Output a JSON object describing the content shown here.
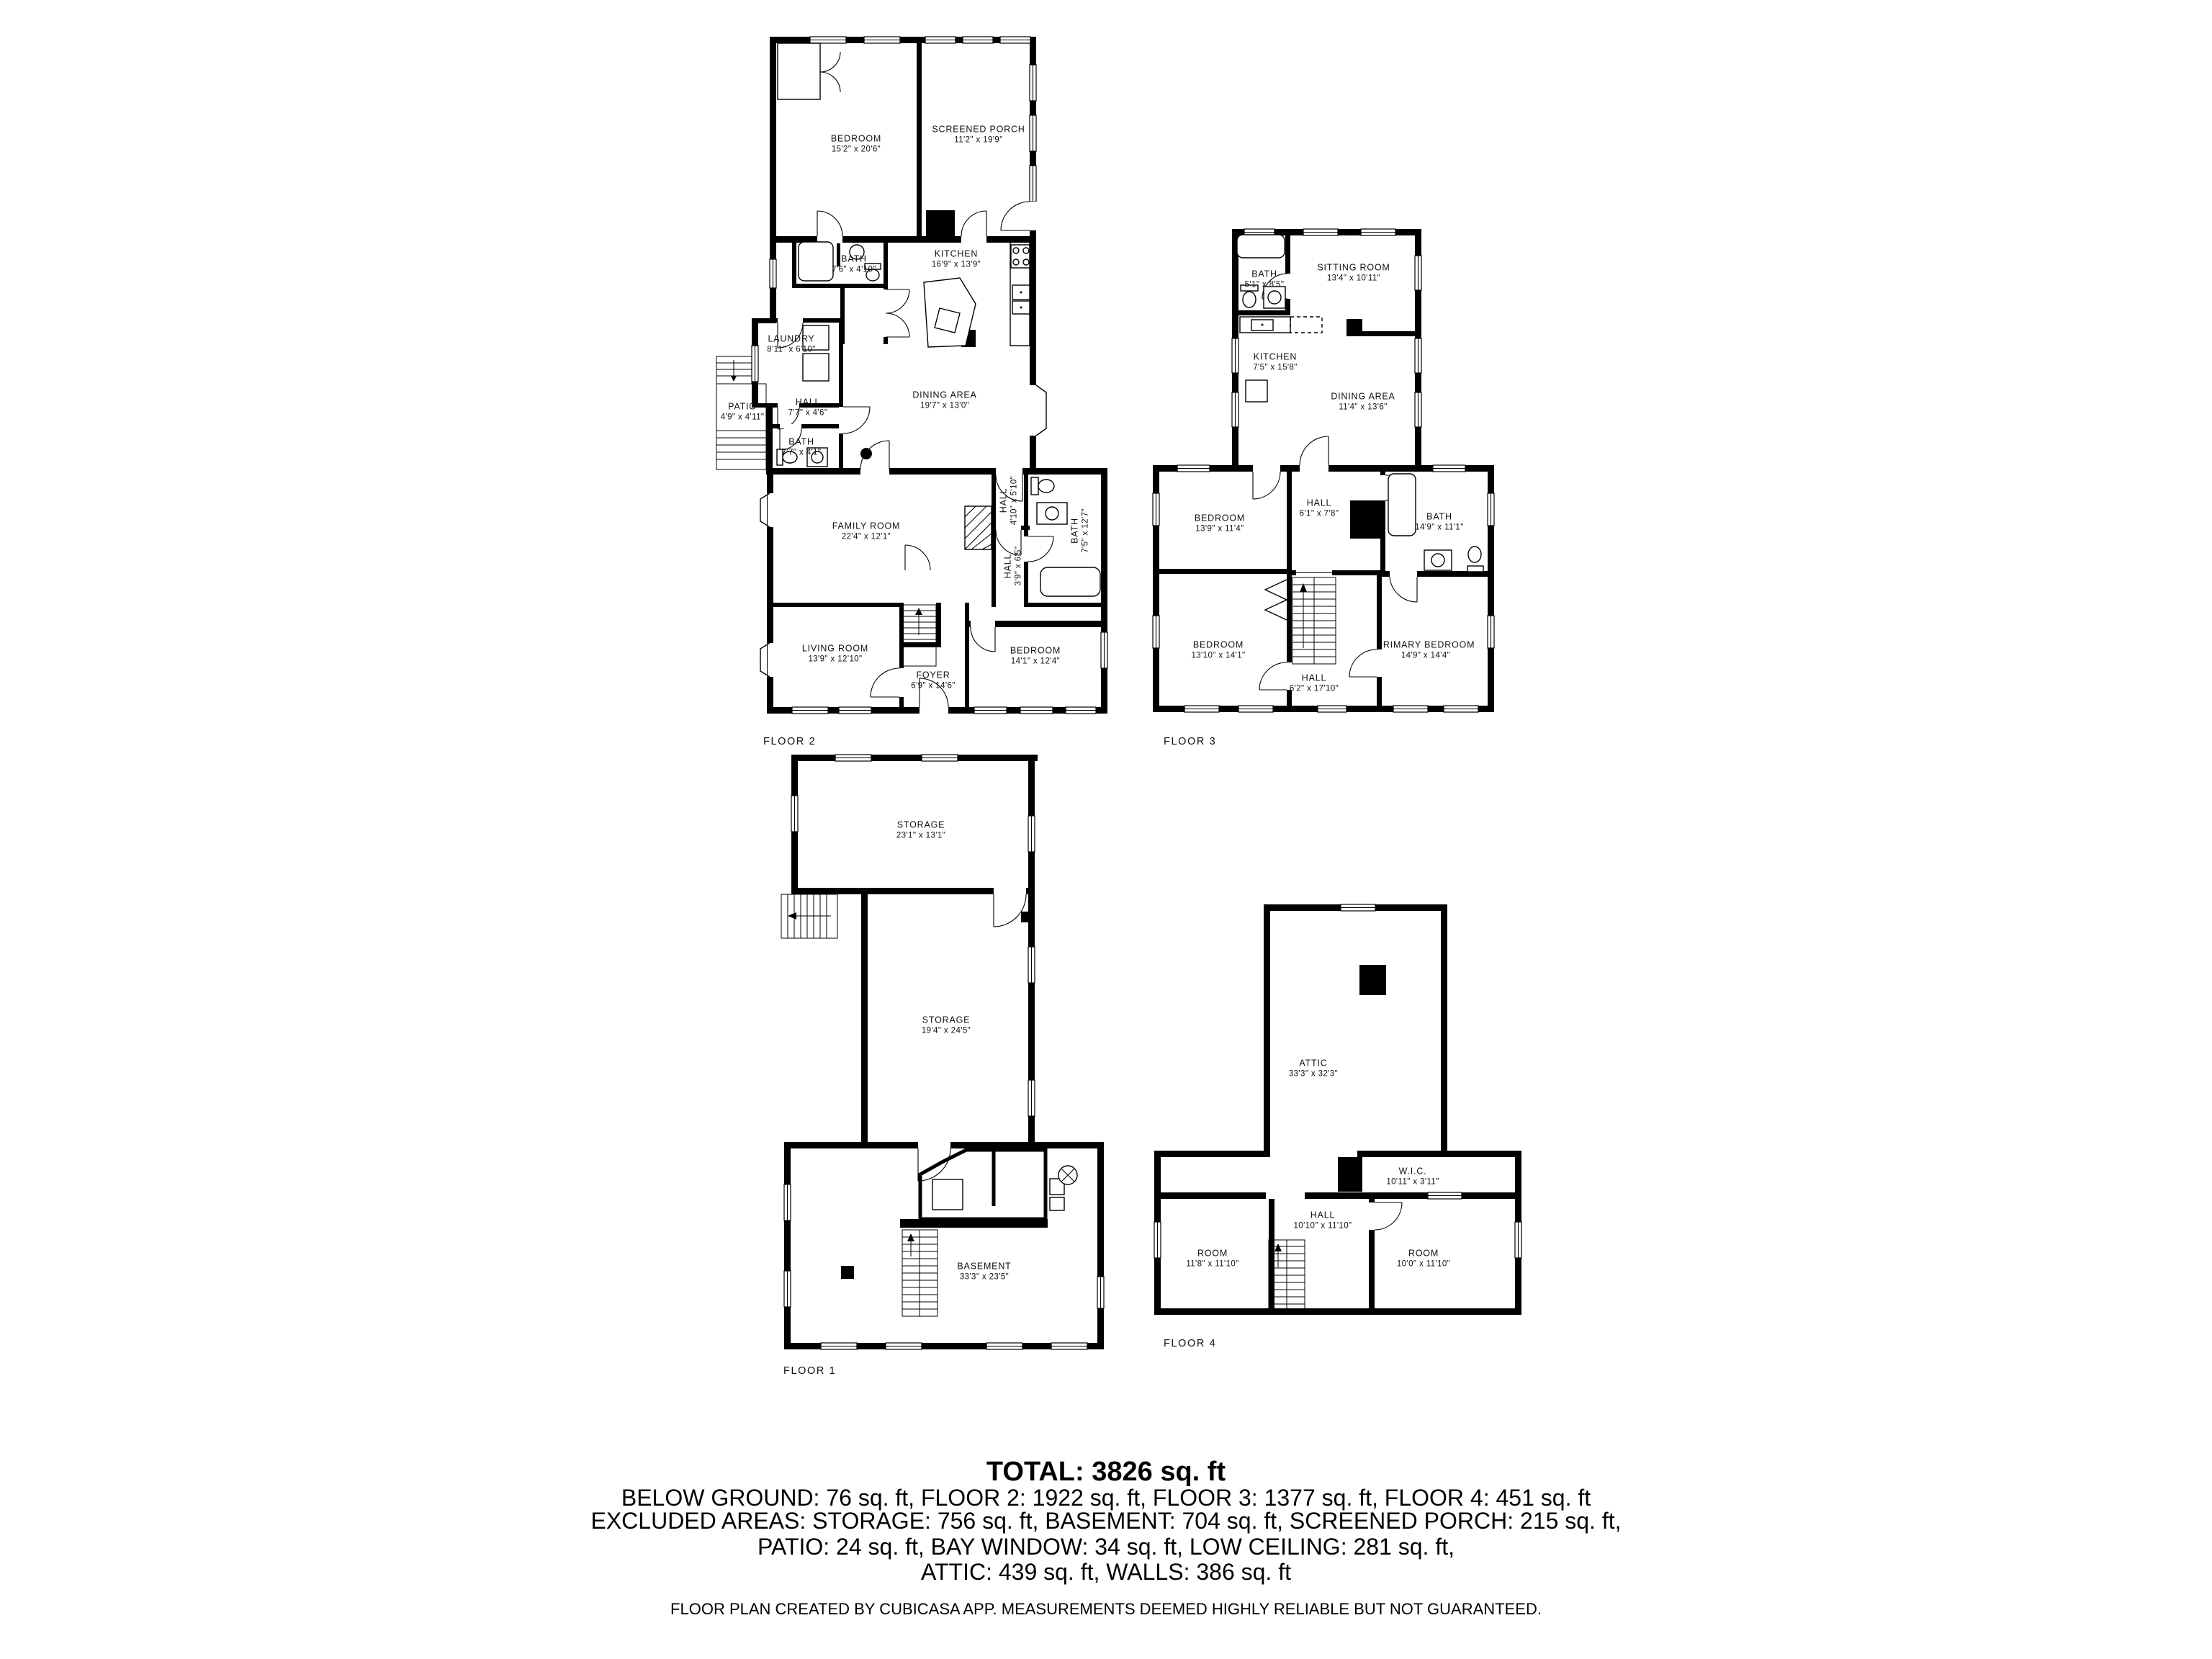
{
  "colors": {
    "wall": "#000000",
    "text": "#111111",
    "background": "#ffffff"
  },
  "floors": [
    {
      "label": "FLOOR 2",
      "rooms": [
        {
          "name": "BEDROOM",
          "dims": "15'2\" x 20'6\""
        },
        {
          "name": "SCREENED PORCH",
          "dims": "11'2\" x 19'9\""
        },
        {
          "name": "BATH",
          "dims": "7'6\" x 4'10\""
        },
        {
          "name": "KITCHEN",
          "dims": "16'9\" x 13'9\""
        },
        {
          "name": "LAUNDRY",
          "dims": "8'11\" x 6'10\""
        },
        {
          "name": "PATIO",
          "dims": "4'9\" x 4'11\""
        },
        {
          "name": "HALL",
          "dims": "7'7\" x 4'6\""
        },
        {
          "name": "BATH",
          "dims": "7'7\" x 4'1\""
        },
        {
          "name": "DINING AREA",
          "dims": "19'7\" x 13'0\""
        },
        {
          "name": "FAMILY ROOM",
          "dims": "22'4\" x 12'1\""
        },
        {
          "name": "HALL",
          "dims": "4'10\" x 5'10\""
        },
        {
          "name": "BATH",
          "dims": "7'5\" x 12'7\""
        },
        {
          "name": "HALL",
          "dims": "3'9\" x 6'5\""
        },
        {
          "name": "LIVING ROOM",
          "dims": "13'9\" x 12'10\""
        },
        {
          "name": "FOYER",
          "dims": "6'9\" x 14'6\""
        },
        {
          "name": "BEDROOM",
          "dims": "14'1\" x 12'4\""
        }
      ]
    },
    {
      "label": "FLOOR 3",
      "rooms": [
        {
          "name": "BATH",
          "dims": "5'1\" x 8'5\""
        },
        {
          "name": "SITTING ROOM",
          "dims": "13'4\" x 10'11\""
        },
        {
          "name": "KITCHEN",
          "dims": "7'5\" x 15'8\""
        },
        {
          "name": "DINING AREA",
          "dims": "11'4\" x 13'6\""
        },
        {
          "name": "BEDROOM",
          "dims": "13'9\" x 11'4\""
        },
        {
          "name": "HALL",
          "dims": "6'1\" x 7'8\""
        },
        {
          "name": "BATH",
          "dims": "14'9\" x 11'1\""
        },
        {
          "name": "BEDROOM",
          "dims": "13'10\" x 14'1\""
        },
        {
          "name": "HALL",
          "dims": "6'2\" x 17'10\""
        },
        {
          "name": "PRIMARY BEDROOM",
          "dims": "14'9\" x 14'4\""
        }
      ]
    },
    {
      "label": "FLOOR 1",
      "rooms": [
        {
          "name": "STORAGE",
          "dims": "23'1\" x 13'1\""
        },
        {
          "name": "STORAGE",
          "dims": "19'4\" x 24'5\""
        },
        {
          "name": "BASEMENT",
          "dims": "33'3\" x 23'5\""
        }
      ]
    },
    {
      "label": "FLOOR 4",
      "rooms": [
        {
          "name": "ATTIC",
          "dims": "33'3\" x 32'3\""
        },
        {
          "name": "W.I.C.",
          "dims": "10'11\" x 3'11\""
        },
        {
          "name": "HALL",
          "dims": "10'10\" x 11'10\""
        },
        {
          "name": "ROOM",
          "dims": "11'8\" x 11'10\""
        },
        {
          "name": "ROOM",
          "dims": "10'0\" x 11'10\""
        }
      ]
    }
  ],
  "summary": {
    "total": "TOTAL: 3826 sq. ft",
    "lines": [
      "BELOW GROUND: 76 sq. ft, FLOOR 2: 1922 sq. ft, FLOOR 3: 1377 sq. ft, FLOOR 4: 451 sq. ft",
      "EXCLUDED AREAS: STORAGE: 756 sq. ft, BASEMENT: 704 sq. ft, SCREENED PORCH: 215 sq. ft,",
      "PATIO: 24 sq. ft, BAY WINDOW: 34 sq. ft, LOW CEILING: 281 sq. ft,",
      "ATTIC: 439 sq. ft, WALLS: 386 sq. ft"
    ]
  },
  "footer": "FLOOR PLAN CREATED BY CUBICASA APP. MEASUREMENTS DEEMED HIGHLY RELIABLE BUT NOT GUARANTEED."
}
